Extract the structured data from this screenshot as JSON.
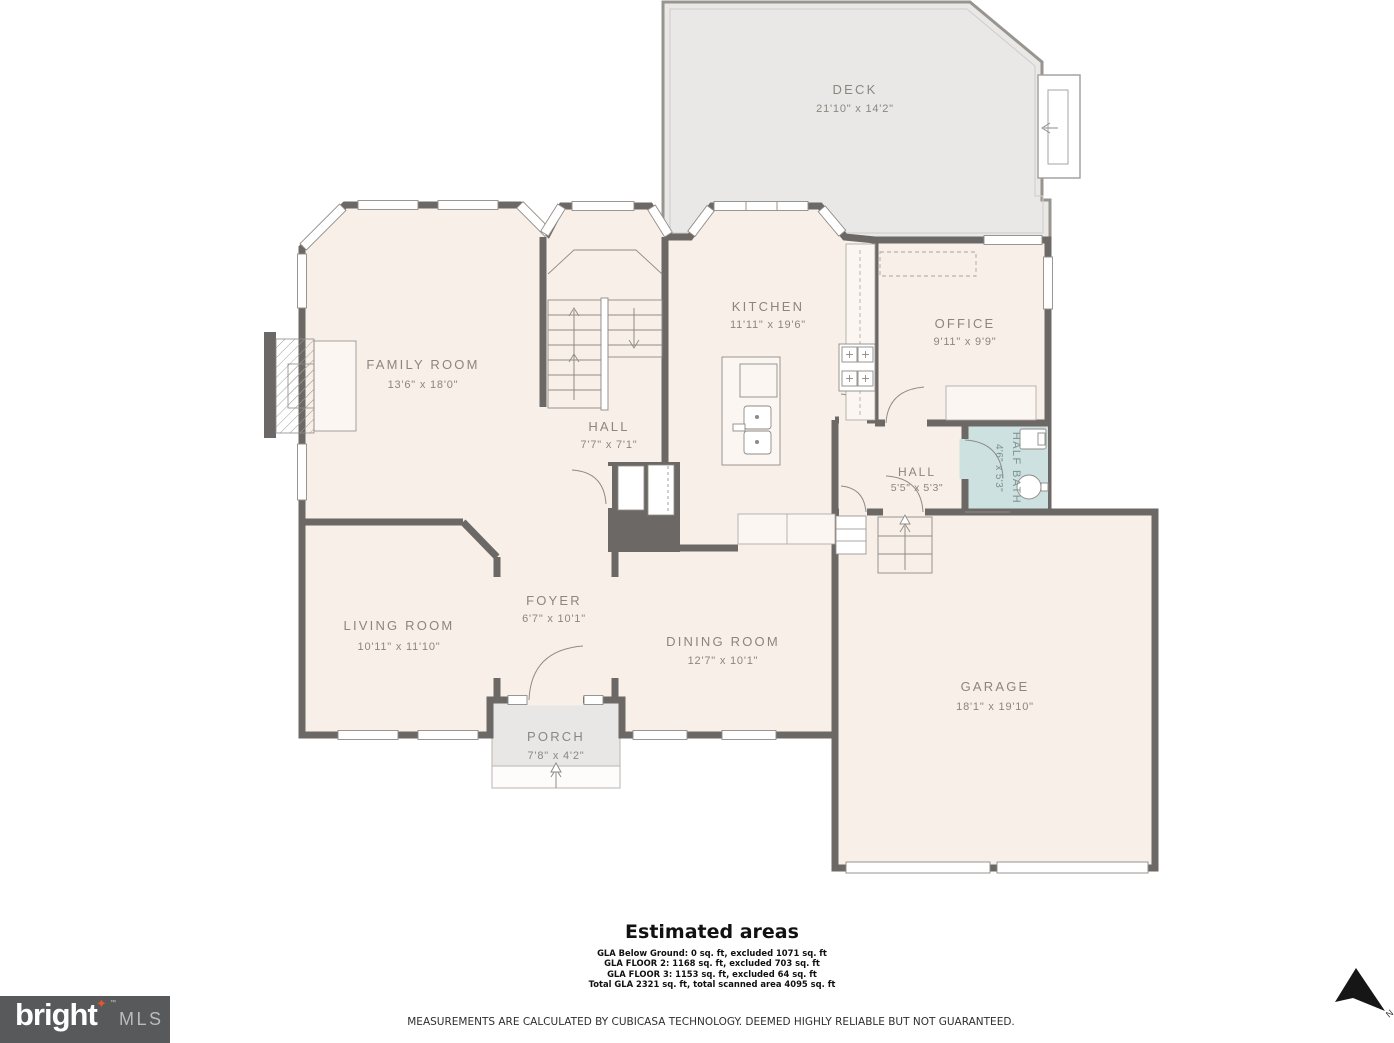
{
  "colors": {
    "wall": "#6C6865",
    "room_fill": "#F8EFE8",
    "deck_fill": "#EAE8E6",
    "bath_fill": "#CDE2E0",
    "label": "#8C8680",
    "logo_bg": "#58595b",
    "logo_star": "#E4572E"
  },
  "rooms": {
    "deck": {
      "label": "DECK",
      "dims": "21'10\" x 14'2\""
    },
    "kitchen": {
      "label": "KITCHEN",
      "dims": "11'11\" x 19'6\""
    },
    "office": {
      "label": "OFFICE",
      "dims": "9'11\" x 9'9\""
    },
    "family_room": {
      "label": "FAMILY ROOM",
      "dims": "13'6\" x 18'0\""
    },
    "hall_upper": {
      "label": "HALL",
      "dims": "7'7\" x 7'1\""
    },
    "hall_lower": {
      "label": "HALL",
      "dims": "5'5\" x 5'3\""
    },
    "half_bath": {
      "label": "HALF BATH",
      "dims": "4'6\" x 5'3\""
    },
    "living_room": {
      "label": "LIVING ROOM",
      "dims": "10'11\" x 11'10\""
    },
    "foyer": {
      "label": "FOYER",
      "dims": "6'7\" x 10'1\""
    },
    "dining_room": {
      "label": "DINING ROOM",
      "dims": "12'7\" x 10'1\""
    },
    "garage": {
      "label": "GARAGE",
      "dims": "18'1\" x 19'10\""
    },
    "porch": {
      "label": "PORCH",
      "dims": "7'8\" x 4'2\""
    }
  },
  "estimated": {
    "title": "Estimated areas",
    "lines": [
      "GLA Below Ground: 0 sq. ft, excluded 1071 sq. ft",
      "GLA FLOOR 2: 1168 sq. ft, excluded 703 sq. ft",
      "GLA FLOOR 3: 1153 sq. ft, excluded 64 sq. ft",
      "Total GLA 2321 sq. ft, total scanned area 4095 sq. ft"
    ]
  },
  "disclaimer": "MEASUREMENTS ARE CALCULATED BY CUBICASA TECHNOLOGY. DEEMED HIGHLY RELIABLE BUT NOT GUARANTEED.",
  "logo": {
    "brand": "bright",
    "suffix": "MLS",
    "tm": "™"
  },
  "compass": {
    "label": "N"
  }
}
